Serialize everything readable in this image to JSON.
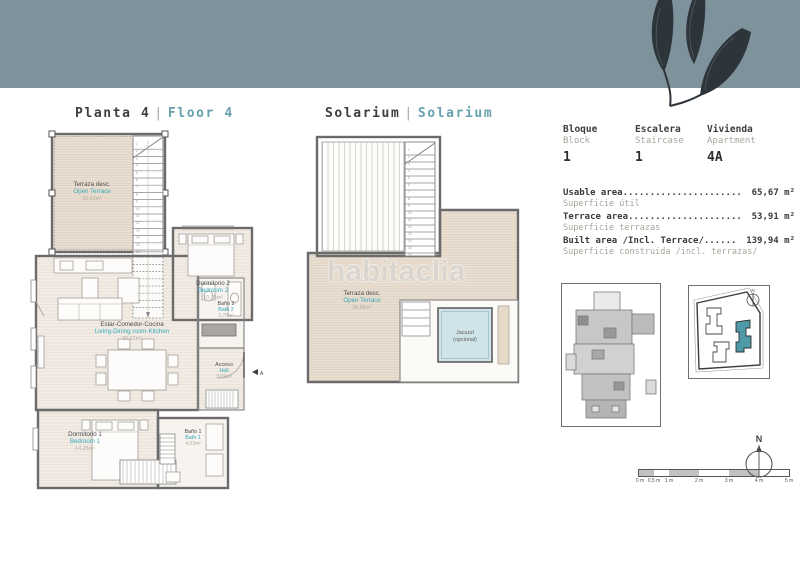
{
  "band_color": "#7d929b",
  "titles": {
    "floor": {
      "es": "Planta 4",
      "sep": "|",
      "en": "Floor 4"
    },
    "solarium": {
      "es": "Solarium",
      "sep": "|",
      "en": "Solarium"
    }
  },
  "watermark": "habitaclia",
  "unit_info": {
    "columns": [
      {
        "label_es": "Bloque",
        "label_en": "Block",
        "value": "1"
      },
      {
        "label_es": "Escalera",
        "label_en": "Staircase",
        "value": "1"
      },
      {
        "label_es": "Vivienda",
        "label_en": "Apartment",
        "value": "4A"
      }
    ]
  },
  "areas": {
    "rows": [
      {
        "label": "Usable area",
        "dots": "......................",
        "value": "65,67 m²",
        "sub": "Superficie útil"
      },
      {
        "label": "Terrace area",
        "dots": ".....................",
        "value": "53,91 m²",
        "sub": "Superficie terrazas"
      },
      {
        "label": "Built area /Incl. Terrace/",
        "dots": " ......",
        "value": "139,94 m²",
        "sub": "Superficie construida /incl. terrazas/"
      }
    ]
  },
  "floor4": {
    "terrace": {
      "es": "Terraza desc.",
      "en": "Open Terrace",
      "area": "16,93m²"
    },
    "bedroom2": {
      "es": "Dormitorio 2",
      "en": "Bedroom 2",
      "area": "10,05m²"
    },
    "living": {
      "es": "Estar-Comedor-Cocina",
      "en": "Living-Dining room-Kitchen",
      "area": "30,62m²"
    },
    "bath2": {
      "es": "Baño 2",
      "en": "Bath 2",
      "area": "3,70m²"
    },
    "hall": {
      "es": "Acceso",
      "en": "Hall",
      "area": "3,02m²"
    },
    "bedroom1": {
      "es": "Dormitorio 1",
      "en": "Bedroom 1",
      "area": "14,25m²"
    },
    "bath1": {
      "es": "Baño 1",
      "en": "Bath 1",
      "area": "4,03m²"
    },
    "section_marker": "A",
    "stairs": {
      "count": 16
    }
  },
  "solarium": {
    "terrace": {
      "es": "Terraza desc.",
      "en": "Open Terrace",
      "area": "36,98m²"
    },
    "jacuzzi": {
      "line1": "Jacuzzi",
      "line2": "(opcional)"
    },
    "stairs": {
      "count": 16
    }
  },
  "site_plan": {
    "highlight_color": "#4f9aa8"
  },
  "scale_bar": {
    "labels": [
      "0 m",
      "0,5 m",
      "1 m",
      "2 m",
      "3 m",
      "4 m",
      "5 m"
    ]
  },
  "compass": {
    "label": "N"
  }
}
